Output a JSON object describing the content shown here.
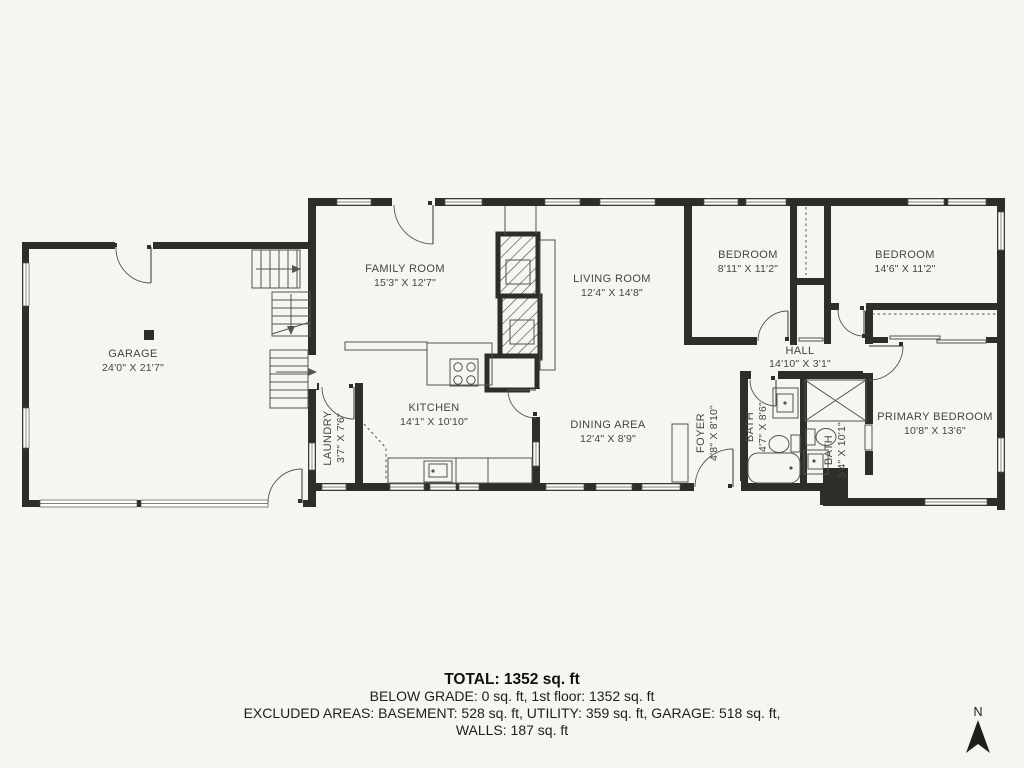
{
  "rooms": {
    "garage": {
      "name": "GARAGE",
      "dims": "24'0\" X 21'7\""
    },
    "family": {
      "name": "FAMILY ROOM",
      "dims": "15'3\" X 12'7\""
    },
    "living": {
      "name": "LIVING ROOM",
      "dims": "12'4\" X 14'8\""
    },
    "bedroom1": {
      "name": "BEDROOM",
      "dims": "8'11\" X 11'2\""
    },
    "bedroom2": {
      "name": "BEDROOM",
      "dims": "14'6\" X 11'2\""
    },
    "kitchen": {
      "name": "KITCHEN",
      "dims": "14'1\" X 10'10\""
    },
    "laundry": {
      "name": "LAUNDRY",
      "dims": "3'7\" X 7'6\""
    },
    "dining": {
      "name": "DINING AREA",
      "dims": "12'4\" X 8'9\""
    },
    "foyer": {
      "name": "FOYER",
      "dims": "4'8\" X 8'10\""
    },
    "bath1": {
      "name": "BATH",
      "dims": "4'7\" X 8'6\""
    },
    "hall": {
      "name": "HALL",
      "dims": "14'10\" X 3'1\""
    },
    "bath2": {
      "name": "BATH",
      "dims": "5'4\" X 10'1\""
    },
    "primary": {
      "name": "PRIMARY BEDROOM",
      "dims": "10'8\" X 13'6\""
    }
  },
  "summary": {
    "total": "TOTAL: 1352 sq. ft",
    "below_grade": "BELOW GRADE: 0 sq. ft, 1st floor: 1352 sq. ft",
    "excluded": "EXCLUDED AREAS: BASEMENT: 528 sq. ft, UTILITY: 359 sq. ft, GARAGE: 518 sq. ft,",
    "walls": "WALLS: 187 sq. ft"
  },
  "compass": {
    "label": "N"
  },
  "colors": {
    "background": "#f7f5ef",
    "wall": "#2e2d2a",
    "line": "#55534d",
    "text": "#45443f",
    "window_fill": "#ffffff"
  }
}
